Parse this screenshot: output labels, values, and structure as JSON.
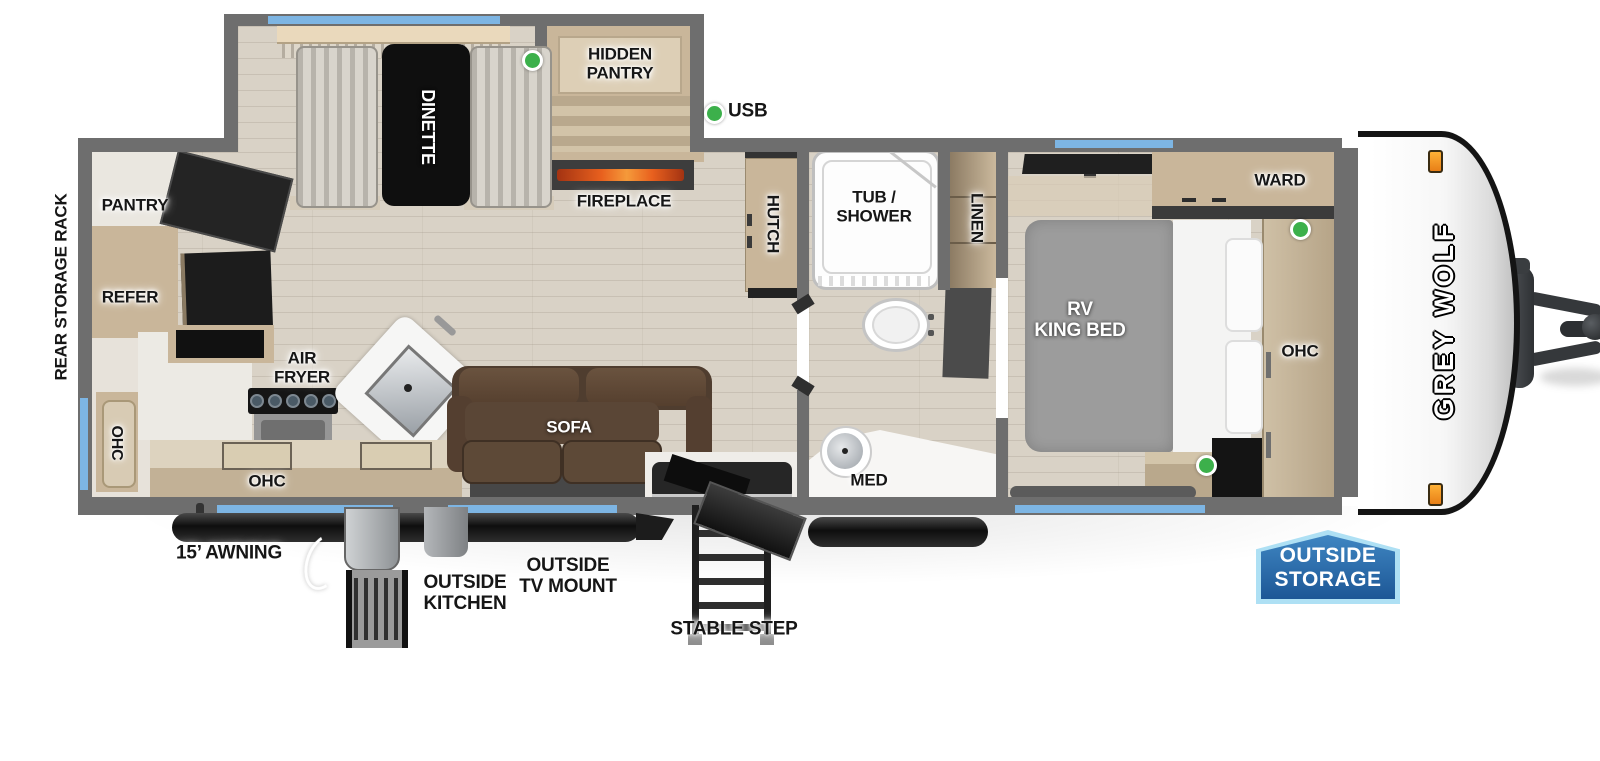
{
  "floorplan": {
    "brand": "GREY WOLF",
    "legend_usb": "USB",
    "badge": {
      "line1": "OUTSIDE",
      "line2": "STORAGE"
    },
    "labels": {
      "rear_storage_rack": "REAR STORAGE RACK",
      "pantry": "PANTRY",
      "refer": "REFER",
      "ohc_rear": "OHC",
      "ohc_kitchen": "OHC",
      "air_fryer": "AIR\nFRYER",
      "dinette": "DINETTE",
      "hidden_pantry": "HIDDEN\nPANTRY",
      "fireplace": "FIREPLACE",
      "hutch": "HUTCH",
      "sofa": "SOFA",
      "tub_shower": "TUB /\nSHOWER",
      "linen": "LINEN",
      "med": "MED",
      "rv_king_bed": "RV\nKING BED",
      "ward": "WARD",
      "ohc_bedroom": "OHC",
      "awning": "15’ AWNING",
      "outside_kitchen": "OUTSIDE\nKITCHEN",
      "outside_tv_mount": "OUTSIDE\nTV MOUNT",
      "stable_step": "STABLE STEP"
    },
    "colors": {
      "wall": "#6e6e6e",
      "window": "#7db5e3",
      "usb-green": "#3cb04b",
      "flame": "#e8601e",
      "badge-light": "#aee0f4",
      "badge-top": "#3f86c2",
      "badge-bottom": "#1d5796",
      "sofa-brown": "#5a4636",
      "wood": "#c9b69a",
      "floor": "#d9d2c6"
    }
  }
}
